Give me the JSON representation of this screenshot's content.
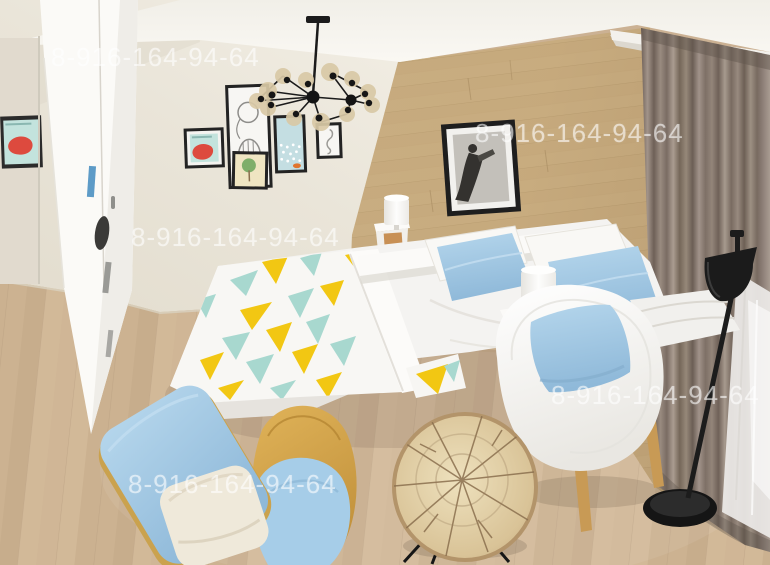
{
  "watermark": {
    "text": "8-916-164-94-64",
    "instances": 5
  },
  "palette": {
    "wall_cream": "#e9e4d8",
    "ceiling": "#f6f4ee",
    "wood_accent_wall": "#c4a87c",
    "curtain_taupe": "#8a7c70",
    "sheer_white": "#eceae7",
    "floor_wood": "#cdb493",
    "bedding_white": "#f4f3f1",
    "pillow_blue": "#a9cfe8",
    "blanket_yellow": "#f2c713",
    "blanket_teal": "#a8d8cf",
    "chair_blue": "#a6cde8",
    "furniture_wood": "#cfa045",
    "black_metal": "#1d1d1d",
    "poster_red": "#dd4a3e",
    "poster_teal": "#c3e3dd"
  }
}
